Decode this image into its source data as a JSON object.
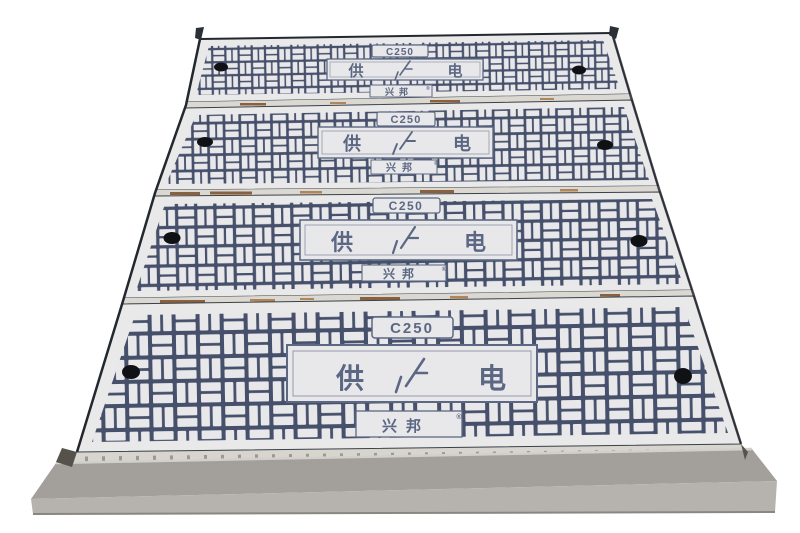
{
  "photo": {
    "subject": "trench-cover-assembly",
    "cover_count": 4
  },
  "colors": {
    "background": "#ffffff",
    "cover_face": "#e9e9ea",
    "groove": "#46506b",
    "engraving": "#5c6883",
    "bolt_hole": "#101114",
    "seam": "#dbd8d2",
    "rust_stain": "#8a5a2c",
    "frame_top_face": "#a3a09c",
    "frame_bottom_face": "#b6b3ae",
    "frame_highlight": "#d2d0cc",
    "frame_shadow": "#8a8782",
    "edge_line": "#23272e"
  },
  "covers": [
    {
      "load_class": "C250",
      "center_left": "供",
      "center_symbol": "lightning-mark",
      "center_right": "电",
      "brand": "兴邦",
      "reg_mark": "®"
    },
    {
      "load_class": "C250",
      "center_left": "供",
      "center_symbol": "lightning-mark",
      "center_right": "电",
      "brand": "兴邦",
      "reg_mark": "®"
    },
    {
      "load_class": "C250",
      "center_left": "供",
      "center_symbol": "lightning-mark",
      "center_right": "电",
      "brand": "兴邦",
      "reg_mark": "®"
    },
    {
      "load_class": "C250",
      "center_left": "供",
      "center_symbol": "lightning-mark",
      "center_right": "电",
      "brand": "兴邦",
      "reg_mark": "®"
    }
  ]
}
